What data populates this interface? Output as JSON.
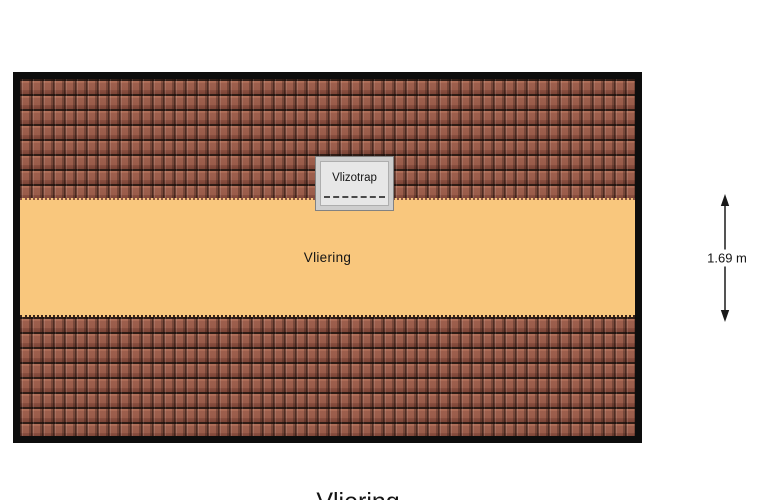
{
  "plan": {
    "type": "attic floor plan",
    "border_color": "#0d0d0d",
    "roof": {
      "pattern": "roof-tile hatching",
      "tile_color": "#9c5e4c",
      "tile_gap_color": "#301d16"
    },
    "room": {
      "label": "Vliering",
      "floor_color": "#f9c77d"
    },
    "hatch": {
      "label": "Vlizotrap",
      "fill_color": "#e7e7e7",
      "border_color": "#cecece"
    }
  },
  "dimension": {
    "label": "1.69 m",
    "orientation": "vertical",
    "arrow_color": "#1a1a1a"
  },
  "caption": {
    "title": "Vliering"
  }
}
